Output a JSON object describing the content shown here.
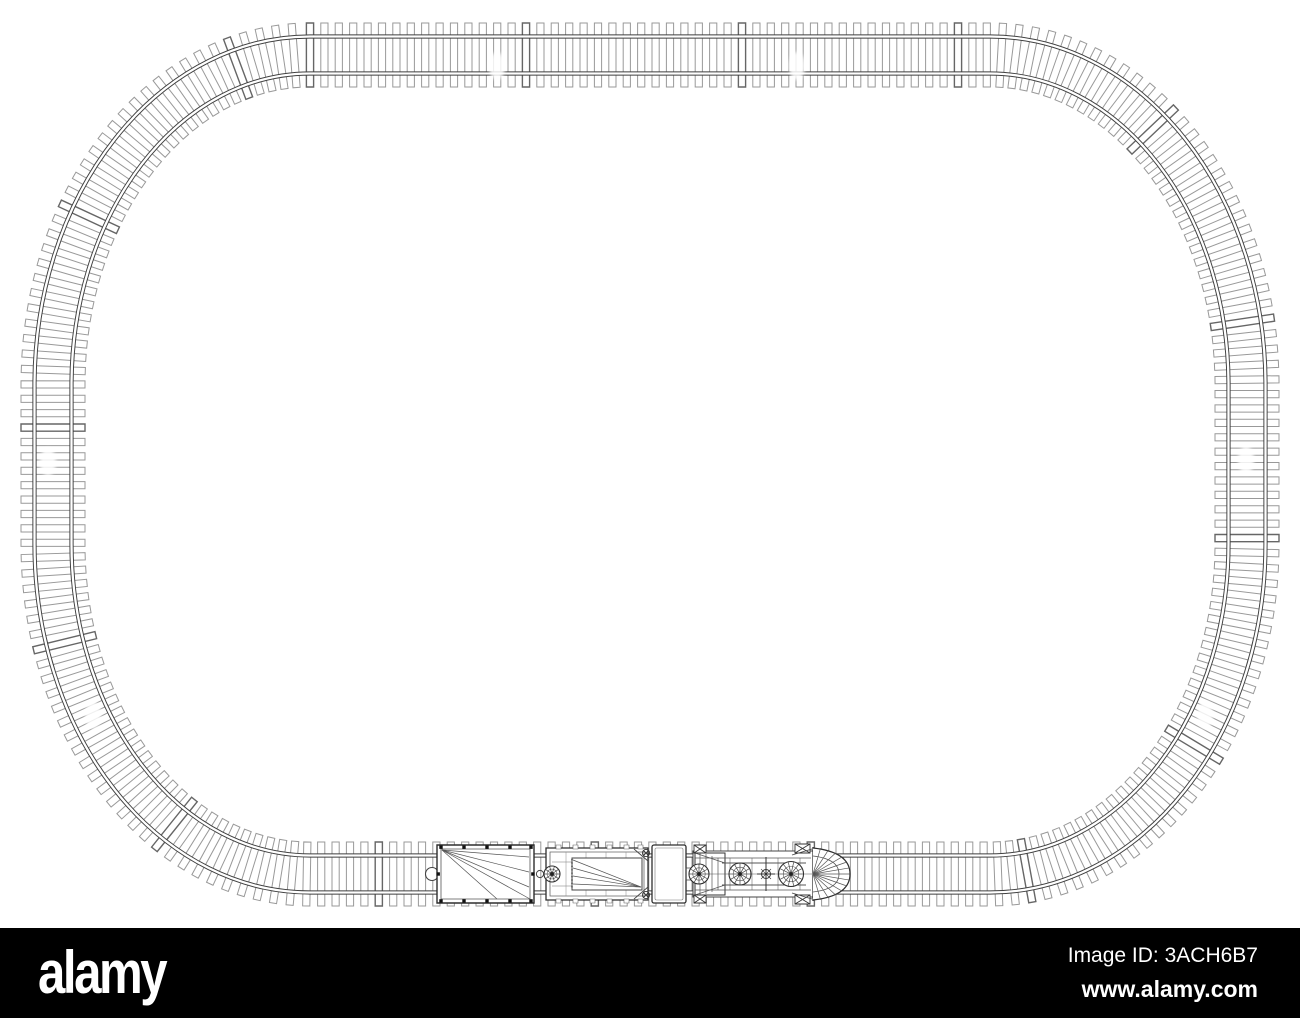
{
  "page": {
    "background": "#ffffff"
  },
  "artwork": {
    "kind": "wireframe-line-drawing",
    "subject": "toy railway oval track with train, top view",
    "line_color": "#3f3f3f",
    "tie_line_color": "#999999",
    "train_cars": [
      "boxcar",
      "flat-wagon",
      "tender",
      "steam-locomotive"
    ]
  },
  "footer": {
    "background": "#000000",
    "text_color": "#ffffff",
    "logo_text": "alamy",
    "image_id": "Image ID: 3ACH6B7",
    "website": "www.alamy.com"
  }
}
